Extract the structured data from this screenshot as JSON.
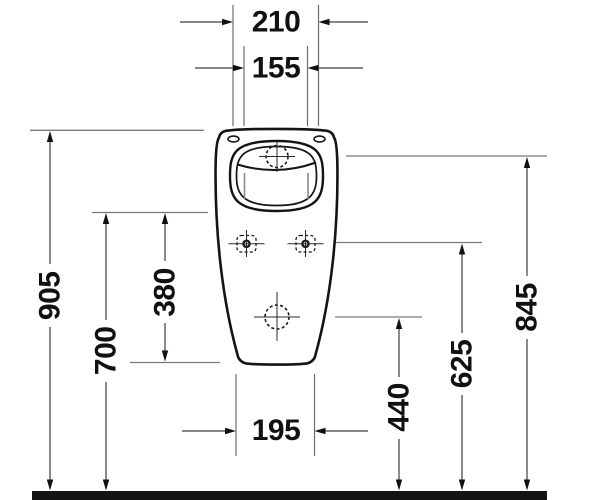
{
  "drawing": {
    "kind": "technical-dimension-drawing",
    "subject": "wall-mounted-urinal-front-elevation",
    "colors": {
      "background": "#ffffff",
      "outline": "#141414",
      "dimension_text": "#111111",
      "thin_lines": "#6e6e6e",
      "floor": "#141414"
    },
    "dimensions": {
      "top_outer_width": "210",
      "top_inner_width": "155",
      "overall_height": "905",
      "rim_bottom_height": "700",
      "rim_to_body_bottom": "380",
      "inlet_height": "845",
      "fixing_holes_height": "625",
      "outlet_height": "440",
      "bottom_width": "195"
    }
  }
}
